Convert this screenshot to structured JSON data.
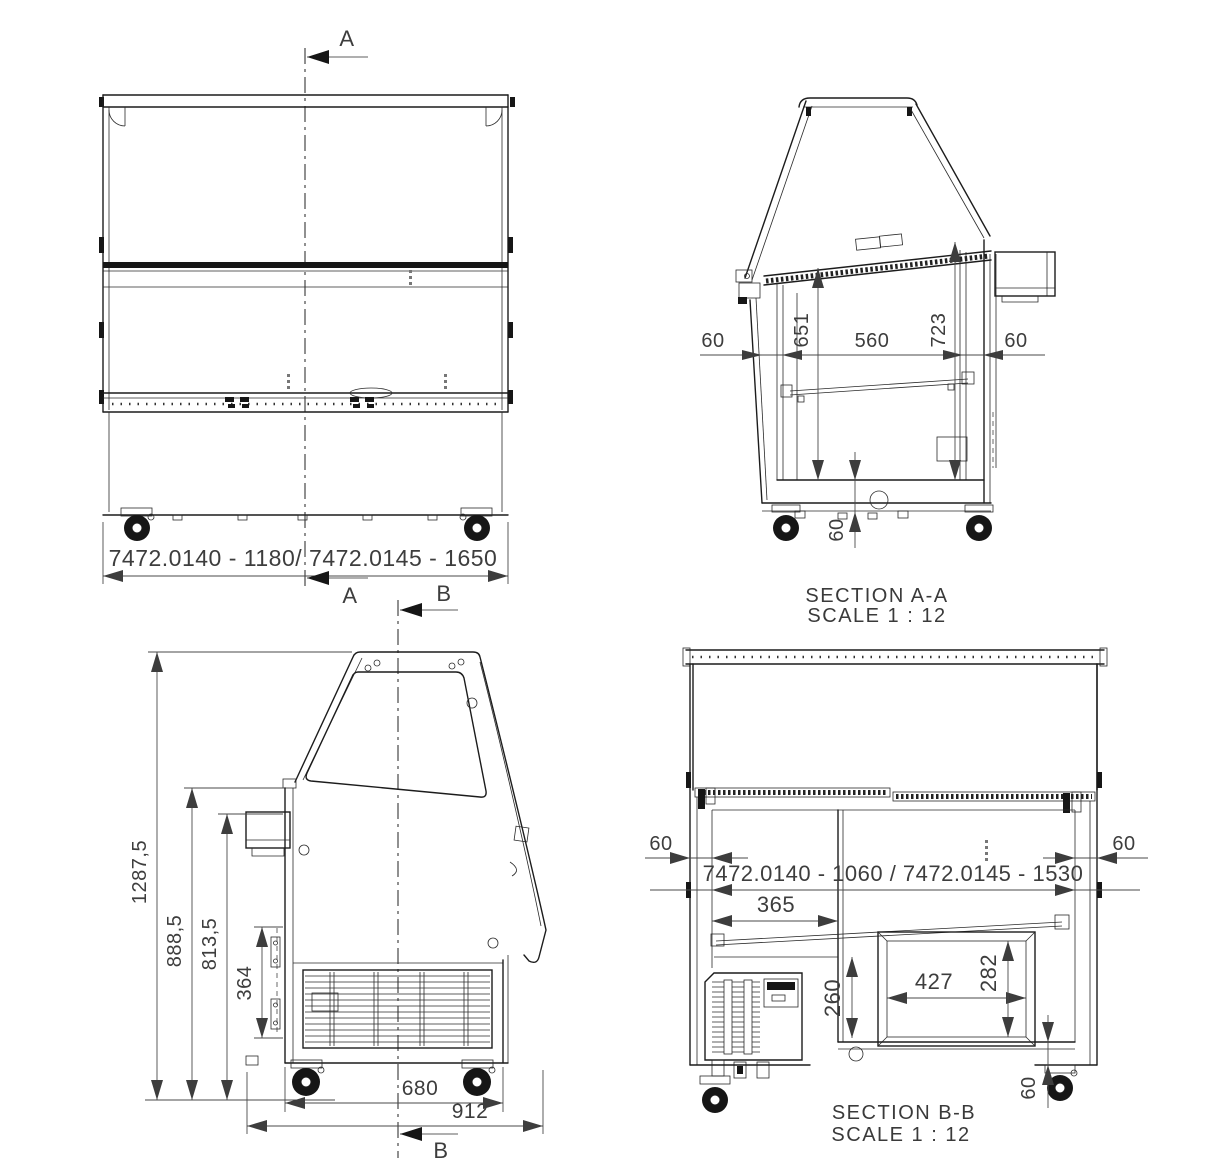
{
  "front_view": {
    "width_dim": "7472.0140  - 1180/ 7472.0145  - 1650",
    "section_a": "A",
    "section_b": "B"
  },
  "section_aa": {
    "title": "SECTION A-A",
    "scale": "SCALE 1 : 12",
    "dim_left_gap": "60",
    "dim_inner_width": "560",
    "dim_right_gap": "60",
    "dim_depth_front": "651",
    "dim_depth_back": "723",
    "dim_base_height": "60"
  },
  "side_view": {
    "section_b": "B",
    "dim_total_height": "1287,5",
    "dim_height_back": "888,5",
    "dim_height_front": "813,5",
    "dim_hinge_span": "364",
    "dim_body_depth": "680",
    "dim_total_depth": "912"
  },
  "section_bb": {
    "title": "SECTION B-B",
    "scale": "SCALE 1 : 12",
    "dim_left_gap": "60",
    "dim_right_gap": "60",
    "dim_inner_width": "7472.0140 - 1060 / 7472.0145 - 1530",
    "dim_well_width": "365",
    "dim_well_depth": "260",
    "dim_opening_width": "427",
    "dim_opening_height": "282",
    "dim_base_height": "60"
  },
  "colors": {
    "line": "#1c1c1c",
    "dimension": "#4a4a4a",
    "text": "#3d3d3d",
    "background": "#ffffff"
  }
}
